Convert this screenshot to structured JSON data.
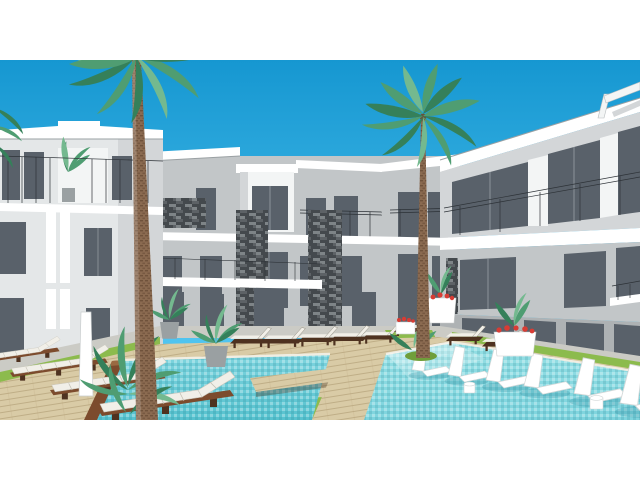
{
  "meta": {
    "type": "architectural-rendering",
    "description": "3D visualization of a modern white resort apartment complex arranged around a courtyard with tiled swimming pools, wooden decks, sun loungers, stacked-stone feature columns and two tall palm trees under a clear blue sky",
    "visible_text": "none"
  },
  "colors": {
    "white": "#ffffff",
    "bldg_white": "#f3f5f5",
    "bldg_light": "#e4e7e8",
    "bldg_mid": "#d3d6d8",
    "bldg_gray": "#c2c6c8",
    "bldg_dark": "#aeb2b4",
    "glass": "#59616a",
    "glass_hi": "#7d858e",
    "frame": "#2d3237",
    "slab_shadow": "#9aa0a3",
    "stone_a": "#44494d",
    "stone_b": "#5d6266",
    "stone_c": "#7e8487",
    "sky_top": "#1697d1",
    "sky_bot": "#55c8f2",
    "water_hi": "#7ed4de",
    "water": "#57c2cf",
    "water_sh": "#95dfe4",
    "deck": "#d9cba6",
    "deck_line": "#b7a47c",
    "wood": "#7c4b2d",
    "wood_dark": "#4e3220",
    "grass": "#8cbb4d",
    "grass_dark": "#6f9e3a",
    "path": "#cbcbc5",
    "cushion": "#f1efe8",
    "leaf": "#4f9d72",
    "leaf_dark": "#35805a",
    "leaf_light": "#74b98f",
    "trunk": "#8a6a50",
    "pot": "#9aa0a2",
    "flower": "#d83c34"
  },
  "scene": {
    "sky": {
      "label": "clear blue sky"
    },
    "buildings": {
      "left_wing": {
        "label": "left apartment wing",
        "floors_visible": 3
      },
      "center_block": {
        "label": "center block with stacked-stone columns",
        "floors_visible": 3,
        "stone_columns": 2
      },
      "right_wing": {
        "label": "right apartment wing with glass balconies",
        "floors_visible": 3
      }
    },
    "palm_trees": 2,
    "pools": {
      "left_pool": {
        "label": "tiled pool with wooden bridge"
      },
      "right_pool": {
        "label": "sun-shelf pool with in-water loungers",
        "in_pool_loungers": 6
      }
    },
    "loungers": {
      "foreground_wood_loungers": 4,
      "poolside_loungers": 8
    },
    "planters_with_red_flowers": 3,
    "potted_plants": 5,
    "outdoor_shower_pillar": 1
  }
}
